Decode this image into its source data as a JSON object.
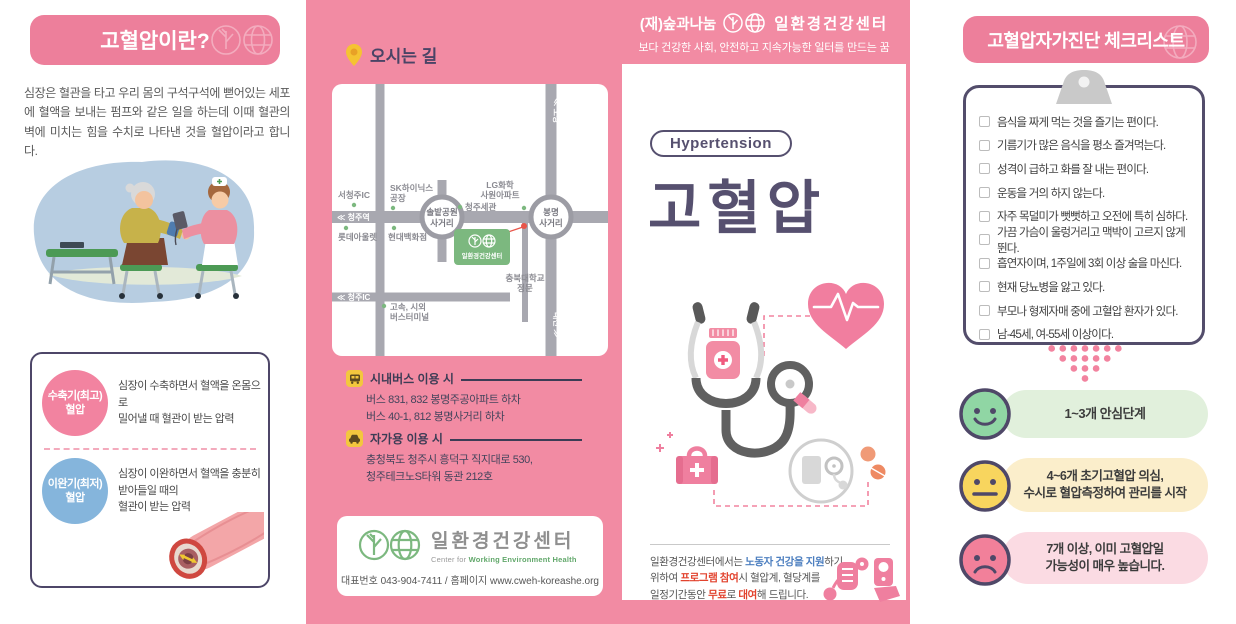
{
  "left": {
    "header": "고혈압이란?",
    "intro": "심장은 혈관을 타고 우리 몸의 구석구석에 뻗어있는 세포에 혈액을 보내는 펌프와 같은 일을 하는데 이때 혈관의 벽에 미치는 힘을 수치로 나타낸 것을 혈압이라고 합니다.",
    "systolic_label": "수축기(최고)\n혈압",
    "systolic_desc": "심장이 수축하면서 혈액을 온몸으로\n밀어낼 때 혈관이 받는 압력",
    "diastolic_label": "이완기(최저)\n혈압",
    "diastolic_desc": "심장이 이완하면서 혈액을 충분히\n받아들일 때의\n혈관이 받는 압력"
  },
  "directions": {
    "title": "오시는 길",
    "bus_title": "시내버스 이용 시",
    "bus_lines": "버스 831, 832 봉명주공아파트 하차\n버스 40-1, 812 봉명사거리 하차",
    "car_title": "자가용 이용 시",
    "car_lines": "충청북도 청주시 흥덕구 직지대로 530,\n청주테크노S타워 동관 212호",
    "footer_org": "일환경건강센터",
    "footer_sub_prefix": "Center for ",
    "footer_sub_green": "Working Environment Health",
    "footer_contact": "대표번호 043-904-7411 / 홈페이지 www.cweh-koreashe.org",
    "map": {
      "seocheongju_ic": "서청주IC",
      "cheongju_station": "≪ 청주역",
      "sk1": "SK하이닉스",
      "sk2": "공장",
      "lg1": "LG화학",
      "lg2": "사원아파트",
      "customs": "청주세관",
      "solbat1": "솔밭공원",
      "solbat2": "사거리",
      "bongmyeong1": "봉명",
      "bongmyeong2": "사거리",
      "lotte": "롯데아울렛",
      "hyundai": "현대백화점",
      "center_name": "일환경건강센터",
      "univ1": "충북대학교",
      "univ2": "정문",
      "cheongju_ic": "≪ 청주IC",
      "terminal1": "고속, 시외",
      "terminal2": "버스터미널",
      "ochang": "≪ 오창",
      "daejeon": "대전 ≫"
    }
  },
  "cover": {
    "org_prefix": "(재)숲과나눔",
    "org_name": "일환경건강센터",
    "tagline": "보다 건강한 사회, 안전하고 지속가능한 일터를 만드는 꿈",
    "badge": "Hypertension",
    "title": "고혈압",
    "note_segments": [
      {
        "text": "일환경건강센터에서는 ",
        "style": "default"
      },
      {
        "text": "노동자 건강을 지원",
        "style": "blue"
      },
      {
        "text": "하기\n위하여 ",
        "style": "default"
      },
      {
        "text": "프로그램 참여",
        "style": "red"
      },
      {
        "text": "시 혈압계, 혈당계를\n일정기간동안 ",
        "style": "default"
      },
      {
        "text": "무료",
        "style": "red"
      },
      {
        "text": "로 ",
        "style": "default"
      },
      {
        "text": "대여",
        "style": "red"
      },
      {
        "text": "해 드립니다.",
        "style": "default"
      }
    ]
  },
  "checklist": {
    "title": "고혈압자가진단 체크리스트",
    "items": [
      "음식을 짜게 먹는 것을 즐기는 편이다.",
      "기름기가 많은 음식을 평소 즐겨먹는다.",
      "성격이 급하고 화를 잘 내는 편이다.",
      "운동을 거의 하지 않는다.",
      "자주 목덜미가 뻣뻣하고 오전에 특히 심하다.",
      "가끔 가슴이 울렁거리고 맥박이 고르지 않게 뛴다.",
      "흡연자이며, 1주일에 3회 이상 술을 마신다.",
      "현재 당뇨병을 앓고 있다.",
      "부모나 형제자매 중에 고혈압 환자가 있다.",
      "남-45세, 여-55세 이상이다."
    ],
    "results": [
      {
        "text": "1~3개 안심단계"
      },
      {
        "text": "4~6개 초기고혈압 의심,\n수시로 혈압측정하여 관리를 시작"
      },
      {
        "text": "7개 이상, 이미 고혈압일\n가능성이 매우 높습니다."
      }
    ]
  },
  "colors": {
    "panel_pink": "#f28ba3",
    "header_pink": "#ed7f9b",
    "purple": "#56506f",
    "accent_pink": "#f2839f",
    "green_face": "#90d6a4",
    "yellow_face": "#f8d55e",
    "pink_face": "#f2809a",
    "logo_green": "#7cb87f"
  }
}
